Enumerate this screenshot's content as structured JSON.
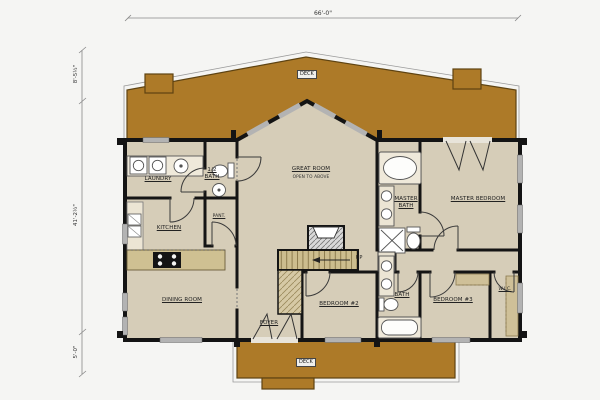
{
  "drawing": {
    "type_label": "first floor plan",
    "dims": {
      "top": "66'-0\"",
      "left_segments": [
        "8'-5½\"",
        "41'-2½\"",
        "5'-0\""
      ]
    },
    "rooms": {
      "great_room": "GREAT ROOM",
      "great_room_sub": "OPEN TO ABOVE",
      "laundry": "LAUNDRY",
      "half_bath": "1/2 BATH",
      "pantry": "PANT.",
      "kitchen": "KITCHEN",
      "dining": "DINING ROOM",
      "foyer": "FOYER",
      "bedroom2": "BEDROOM #2",
      "master_bath": "MASTER BATH",
      "master_bedroom": "MASTER BEDROOM",
      "bath": "BATH",
      "bedroom3": "BEDROOM #3",
      "wic": "W.I.C.",
      "deck_rear": "DECK",
      "deck_front": "DECK",
      "stairs_up": "UP"
    },
    "colors": {
      "deck": "#ad7a28",
      "floor": "#d6cdb8",
      "wall": "#141414",
      "window": "#b3b3b3",
      "tread": "#ccbd8e"
    }
  }
}
